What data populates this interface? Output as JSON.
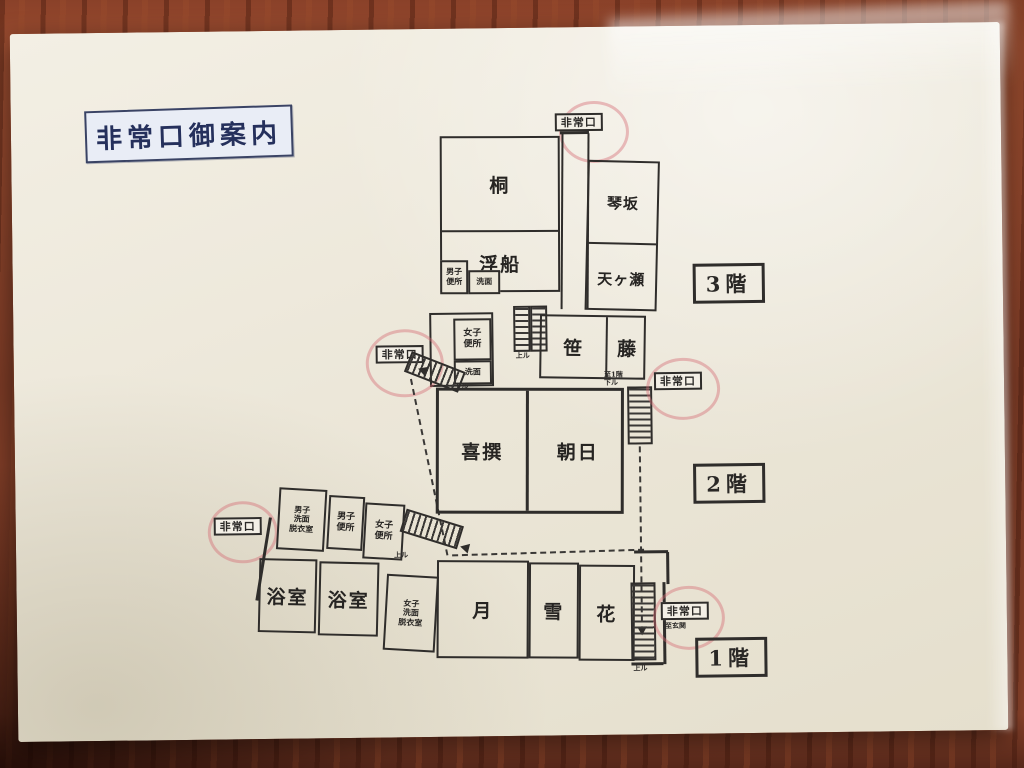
{
  "title": "非常口御案内",
  "colors": {
    "paper": "#ece7d9",
    "ink": "#2f2d2b",
    "wood": "#82402a",
    "title_ink": "#25305c",
    "title_bg": "#e9edf6",
    "exit_ring": "#d36a73"
  },
  "floor3": {
    "label": "3階",
    "exit_top": "非常口",
    "rooms": {
      "kiri": "桐",
      "ukifune": "浮船",
      "kotosaka": "琴坂",
      "amagase": "天ヶ瀬",
      "mens_toilet": "男子\n便所",
      "washbasin": "洗面"
    }
  },
  "floor2": {
    "label": "2階",
    "exit_left": "非常口",
    "exit_right": "非常口",
    "stairs_up_note": "上ル",
    "stairs_left_note": "下ル",
    "stairs_right_note": "至1階\n下ル",
    "rooms": {
      "womens_toilet": "女子\n便所",
      "washbasin": "洗面",
      "sasa": "笹",
      "fuji": "藤",
      "kisen": "喜撰",
      "asahi": "朝日"
    }
  },
  "floor1": {
    "label": "1階",
    "exit_left": "非常口",
    "exit_right": "非常口",
    "exit_right_note": "至玄関",
    "stairs_center_note": "上ル",
    "stairs_right_note": "上ル",
    "rooms": {
      "mens_dressing": "男子\n洗面\n脱衣室",
      "mens_toilet": "男子\n便所",
      "womens_toilet": "女子\n便所",
      "bath_left": "浴室",
      "bath_right": "浴室",
      "womens_dressing": "女子\n洗面\n脱衣室",
      "tsuki": "月",
      "yuki": "雪",
      "hana": "花"
    }
  }
}
